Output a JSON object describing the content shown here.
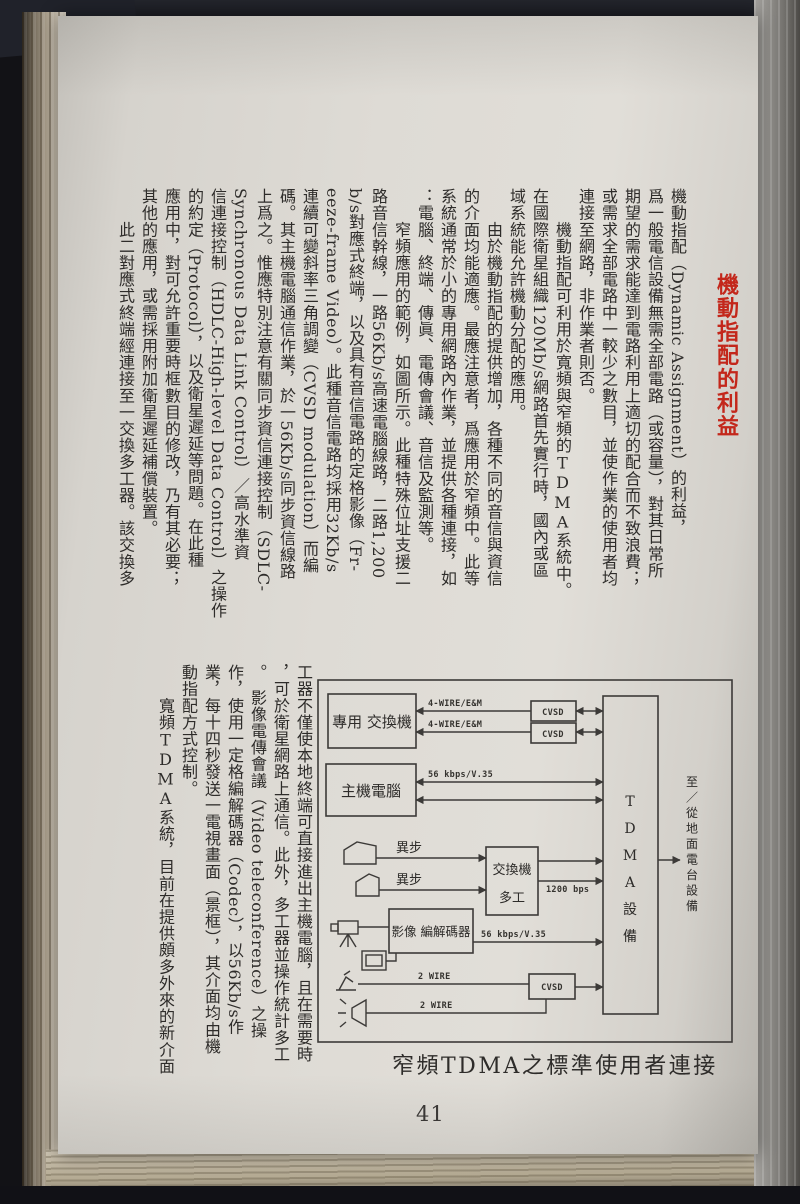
{
  "page": {
    "number": "41",
    "title": "機動指配的利益"
  },
  "article": {
    "upright_terms": [
      "TDMA"
    ],
    "top_columns": [
      "機動指配（Dynamic Assignment）的利益，",
      "爲一般電信設備無需全部電路（或容量），對其日常所",
      "期望的需求能達到電路利用上適切的配合而不致浪費；",
      "或需求全部電路中一較少之數目，並使作業的使用者均",
      "連接至網路，非作業者則否。",
      "　　機動指配可利用於寬頻與窄頻的TDMA系統中。",
      "在國際衛星組織120Mb/s網路首先實行時，國內或區",
      "域系統能允許機動分配的應用。",
      "　　由於機動指配的提供增加，各種不同的音信與資信",
      "的介面均能適應。最應注意者，爲應用於窄頻中。此等",
      "系統通常於小的專用網路內作業，並提供各種連接，如",
      "：電腦、終端、傳眞、電傳會議、音信及監測等。",
      "　　窄頻應用的範例，如圖所示。此種特殊位址支援二",
      "路音信幹線，一路56Kb/s高速電腦線路，二路1,200",
      "b/s對應式終端，以及具有音信電路的定格影像（Fr-",
      "eeze-frame Video）。此種音信電路均採用32Kb/s",
      "連續可變斜率三角調變（CVSD modulation）而編",
      "碼。其主機電腦通信作業，於一56Kb/s同步資信線路",
      "上爲之。惟應特別注意有關同步資信連接控制（SDLC-",
      "Synchronous Data Link Control）／高水準資",
      "信連接控制（HDLC-High-level Data Control）之操作",
      "的約定（Protocol），以及衛星遲延等問題。在此種",
      "應用中，對可允許重要時框數目的修改，乃有其必要；",
      "其他的應用，或需採用附加衛星遲延補償裝置。",
      "　　此二對應式終端經連接至一交換多工器。該交換多"
    ],
    "bottom_columns": [
      "工器不僅使本地終端可直接進出主機電腦，且在需要時",
      "，可於衛星網路上通信。此外，多工器並操作統計多工",
      "。　影像電傳會議（Video teleconference）之操",
      "作，使用一定格編解碼器（Codec），以56Kb/s作",
      "業，每十四秒發送一電視畫面（景框），其介面均由機",
      "動指配方式控制。",
      "　　寬頻TDMA系統，目前在提供頗多外來的新介面"
    ]
  },
  "figure": {
    "caption": "窄頻TDMA之標準使用者連接",
    "boxes": {
      "pbx": "專用 交換機",
      "host": "主機電腦",
      "mux_line1": "交換機",
      "mux_line2": "多工",
      "codec": "影像 編解碼器",
      "tdma": "TDMA設備",
      "cvsd": "CVSD"
    },
    "labels": {
      "four_wire": "4-WIRE/E&M",
      "v35": "56 kbps/V.35",
      "bps1200": "1200 bps",
      "two_wire": "2 WIRE",
      "async": "異步",
      "to_earth": "至／從地面電台設備"
    }
  }
}
